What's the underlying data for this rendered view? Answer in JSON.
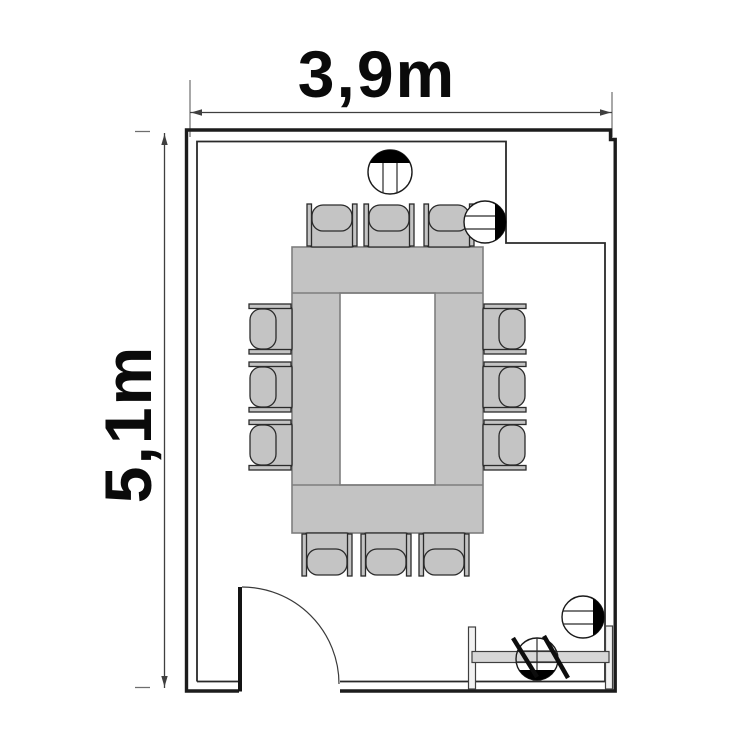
{
  "plan": {
    "dimensions": {
      "width": {
        "label": "3,9m",
        "meters": 3.9
      },
      "height": {
        "label": "5,1m",
        "meters": 5.1
      }
    },
    "room": {
      "kind": "meeting-room",
      "door_position": "bottom-left",
      "door_swing": "quarter-arc",
      "recess": "top-right"
    },
    "furniture": {
      "table": {
        "kind": "conference-table",
        "shape": "rectangle-with-center-opening",
        "seats": 12
      },
      "chairs": {
        "count": 12,
        "per_side": {
          "top": 3,
          "left": 3,
          "right": 3,
          "bottom": 3
        },
        "positions": [
          {
            "x": 332,
            "y": 225,
            "rot": 0
          },
          {
            "x": 389,
            "y": 225,
            "rot": 0
          },
          {
            "x": 449,
            "y": 225,
            "rot": 0
          },
          {
            "x": 270,
            "y": 329,
            "rot": -90
          },
          {
            "x": 270,
            "y": 387,
            "rot": -90
          },
          {
            "x": 270,
            "y": 445,
            "rot": -90
          },
          {
            "x": 505,
            "y": 329,
            "rot": 90
          },
          {
            "x": 505,
            "y": 387,
            "rot": 90
          },
          {
            "x": 505,
            "y": 445,
            "rot": 90
          },
          {
            "x": 327,
            "y": 555,
            "rot": 180
          },
          {
            "x": 386,
            "y": 555,
            "rot": 180
          },
          {
            "x": 444,
            "y": 555,
            "rot": 180
          }
        ]
      },
      "sideboard": {
        "position": "bottom-right"
      }
    },
    "fixtures": {
      "markers": [
        {
          "name": "fixture-marker-top-center",
          "cx": 390,
          "cy": 172,
          "r": 22,
          "segment": "top",
          "seg_d": 9,
          "lines": "vertical",
          "fill": "#ffffff"
        },
        {
          "name": "fixture-marker-upper-right",
          "cx": 485,
          "cy": 222,
          "r": 21,
          "segment": "right",
          "seg_d": 10,
          "lines": "horizontal",
          "fill": "#ffffff"
        },
        {
          "name": "fixture-marker-lower-right",
          "cx": 583,
          "cy": 617,
          "r": 21,
          "segment": "right",
          "seg_d": 10,
          "lines": "horizontal",
          "fill": "#ffffff"
        },
        {
          "name": "fixture-marker-on-sideboard",
          "cx": 537,
          "cy": 659,
          "r": 21,
          "segment": "bottom",
          "seg_d": 11,
          "lines": "cross",
          "fill": "none"
        }
      ],
      "hatch_lines": [
        {
          "x1": 513,
          "y1": 638,
          "x2": 537,
          "y2": 677
        },
        {
          "x1": 544,
          "y1": 636,
          "x2": 568,
          "y2": 678
        }
      ]
    },
    "colors": {
      "wall": "#1c1c1c",
      "inner_wall": "#2a2a2a",
      "dimension": "#3f3f3f",
      "text": "#0a0a0a",
      "table_fill": "#c3c3c3",
      "chair_fill": "#c4c4c4",
      "background": "#ffffff"
    }
  }
}
